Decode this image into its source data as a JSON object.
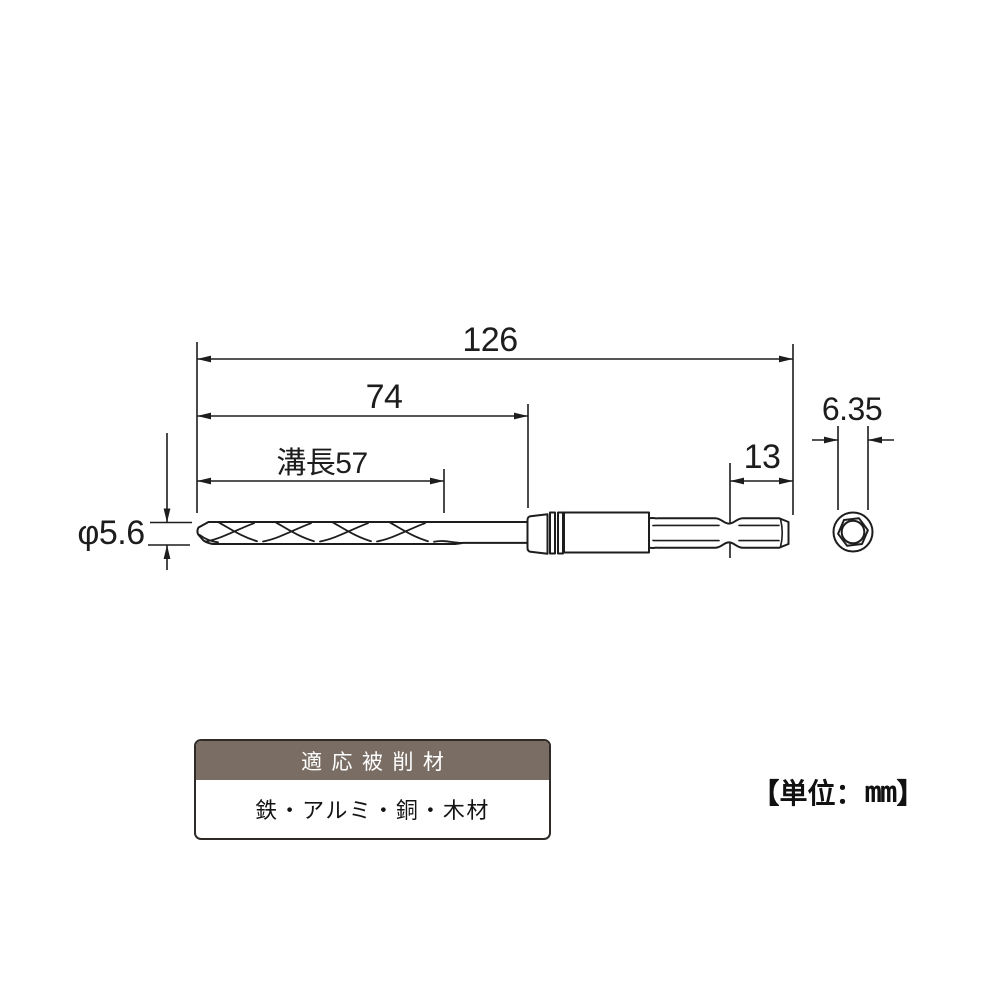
{
  "diagram": {
    "dims": {
      "overall": "126",
      "body_length": "74",
      "flute_length": "溝長57",
      "hex_insert": "13",
      "hex_width": "6.35",
      "diameter": "φ5.6"
    },
    "unit_note": {
      "open": "【",
      "label": "単位：",
      "value": "mm",
      "close": "】"
    }
  },
  "materials_table": {
    "header": "適応被削材",
    "materials": "鉄・アルミ・銅・木材"
  },
  "colors": {
    "line": "#1d1d1d",
    "table_header_bg": "#7a6d64",
    "table_border": "#2e2a28",
    "background": "#ffffff"
  }
}
